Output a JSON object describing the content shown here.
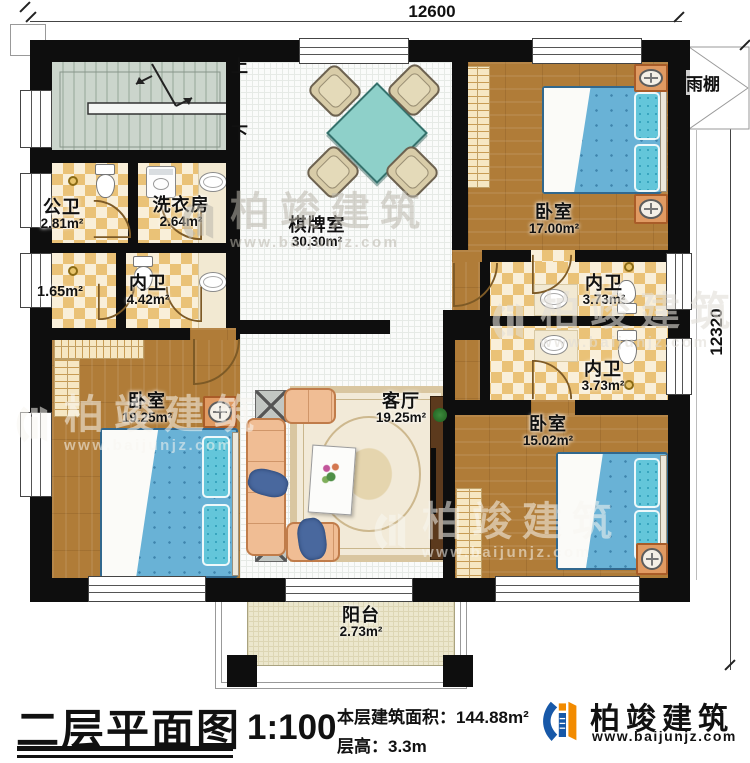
{
  "plan": {
    "dimensions": {
      "width_mm": "12600",
      "height_mm": "12320"
    },
    "stair": {
      "up": "上",
      "down": "下"
    },
    "canopy_label": "雨棚",
    "rooms": {
      "public_bath": {
        "name": "公卫",
        "area": "2.81m²"
      },
      "laundry": {
        "name": "洗衣房",
        "area": "2.64m²"
      },
      "closet_nook": {
        "area": "1.65m²"
      },
      "inner_bath_w": {
        "name": "内卫",
        "area": "4.42m²"
      },
      "game_room": {
        "name": "棋牌室",
        "area": "30.30m²"
      },
      "bedroom_ne": {
        "name": "卧室",
        "area": "17.00m²"
      },
      "inner_bath_e1": {
        "name": "内卫",
        "area": "3.73m²"
      },
      "inner_bath_e2": {
        "name": "内卫",
        "area": "3.73m²"
      },
      "bedroom_sw": {
        "name": "卧室",
        "area": "19.25m²"
      },
      "living": {
        "name": "客厅",
        "area": "19.25m²"
      },
      "bedroom_se": {
        "name": "卧室",
        "area": "15.02m²"
      },
      "balcony": {
        "name": "阳台",
        "area": "2.73m²"
      }
    }
  },
  "footer": {
    "title": "二层平面图",
    "scale": "1:100",
    "area_label": "本层建筑面积：",
    "area_value": "144.88m²",
    "floor_height_label": "层高：",
    "floor_height_value": "3.3m"
  },
  "brand": {
    "name": "柏竣建筑",
    "website": "www.baijunjz.com",
    "blue": "#1758a8",
    "orange": "#f28b00"
  },
  "watermark": {
    "name": "柏竣建筑",
    "website": "www.baijunjz.com"
  }
}
